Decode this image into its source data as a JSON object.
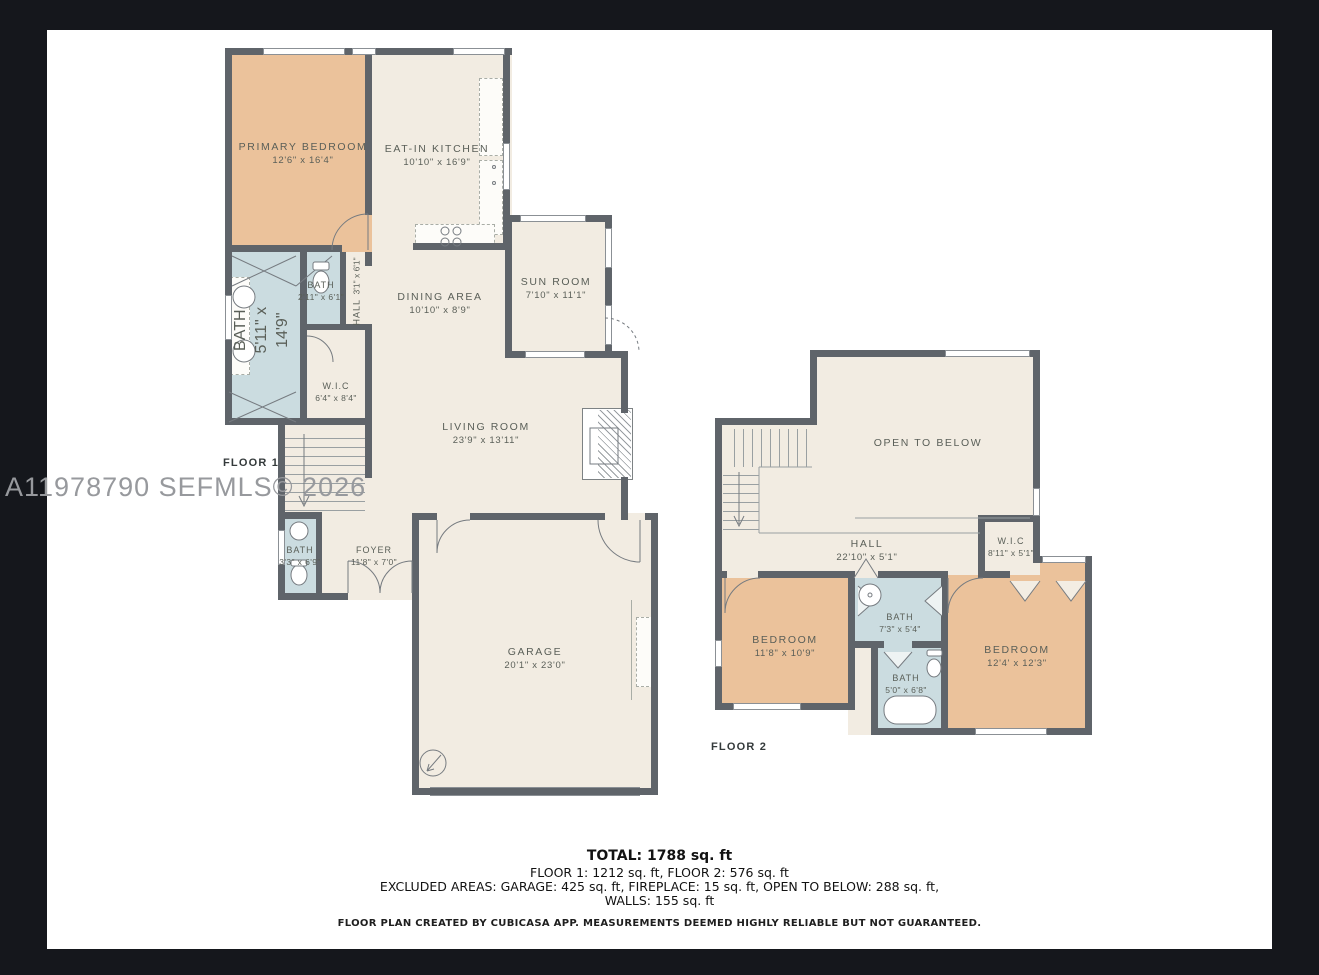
{
  "palette": {
    "bg": "#15171c",
    "sheet": "#ffffff",
    "cream": "#f2ece2",
    "peach": "#ebc29b",
    "blue": "#cbdce0",
    "wall": "#5f646a",
    "label": "#5a5f58",
    "watermark": "#97999d"
  },
  "watermark": "A11978790  SEFMLS© 2026",
  "floor1": {
    "label": "FLOOR 1",
    "rooms": {
      "primary_bedroom": {
        "name": "PRIMARY BEDROOM",
        "dims": "12'6\" x 16'4\""
      },
      "kitchen": {
        "name": "EAT-IN KITCHEN",
        "dims": "10'10\" x 16'9\""
      },
      "bath_large": {
        "name": "BATH",
        "dims": "5'11\" x 14'9\""
      },
      "bath_small": {
        "name": "BATH",
        "dims": "2'11\" x 6'1\""
      },
      "hall": {
        "name": "HALL",
        "dims": "3'1\" x 6'1\""
      },
      "wic": {
        "name": "W.I.C",
        "dims": "6'4\" x 8'4\""
      },
      "dining": {
        "name": "DINING AREA",
        "dims": "10'10\" x 8'9\""
      },
      "sun_room": {
        "name": "SUN ROOM",
        "dims": "7'10\" x 11'1\""
      },
      "living": {
        "name": "LIVING ROOM",
        "dims": "23'9\" x 13'11\""
      },
      "bath_foyer": {
        "name": "BATH",
        "dims": "3'3\" x 6'9\""
      },
      "foyer": {
        "name": "FOYER",
        "dims": "11'8\" x 7'0\""
      },
      "garage": {
        "name": "GARAGE",
        "dims": "20'1\" x 23'0\""
      }
    }
  },
  "floor2": {
    "label": "FLOOR 2",
    "rooms": {
      "open_to_below": {
        "name": "OPEN TO BELOW",
        "dims": ""
      },
      "hall": {
        "name": "HALL",
        "dims": "22'10\" x 5'1\""
      },
      "wic": {
        "name": "W.I.C",
        "dims": "8'11\" x 5'1\""
      },
      "bedroom_left": {
        "name": "BEDROOM",
        "dims": "11'8\" x 10'9\""
      },
      "bath_top": {
        "name": "BATH",
        "dims": "7'3\" x 5'4\""
      },
      "bath_bottom": {
        "name": "BATH",
        "dims": "5'0\" x 6'8\""
      },
      "bedroom_right": {
        "name": "BEDROOM",
        "dims": "12'4' x 12'3\""
      }
    }
  },
  "summary": {
    "total": "TOTAL: 1788 sq. ft",
    "floors": "FLOOR 1: 1212 sq. ft, FLOOR 2: 576 sq. ft",
    "excluded": "EXCLUDED AREAS: GARAGE: 425 sq. ft, FIREPLACE: 15 sq. ft, OPEN TO BELOW: 288 sq. ft,",
    "walls": "WALLS: 155 sq. ft",
    "disclaimer": "FLOOR PLAN CREATED BY CUBICASA APP. MEASUREMENTS DEEMED HIGHLY RELIABLE BUT NOT GUARANTEED."
  }
}
